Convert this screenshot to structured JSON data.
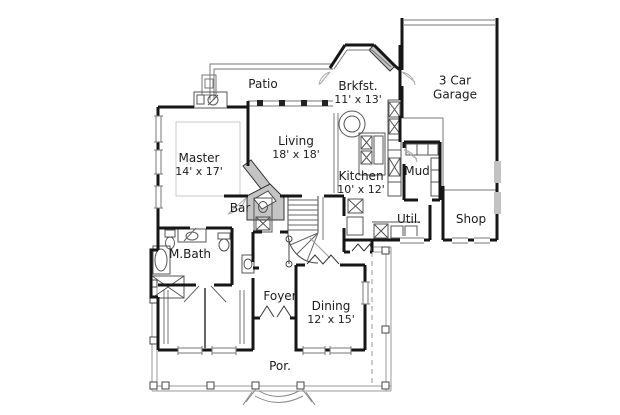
{
  "plan_title": "House floor plan",
  "colors": {
    "wall": "#161616",
    "thin_line": "#555555",
    "light_line": "#9a9a9a",
    "masonry_fill": "#c4c4c4",
    "text": "#1c1c1c",
    "background": "#ffffff"
  },
  "rooms": {
    "patio": {
      "name": "Patio"
    },
    "brkfst": {
      "name": "Brkfst.",
      "dims": "11' x 13'"
    },
    "garage": {
      "line1": "3 Car",
      "line2": "Garage"
    },
    "living": {
      "name": "Living",
      "dims": "18' x 18'"
    },
    "master": {
      "name": "Master",
      "dims": "14' x 17'"
    },
    "kitchen": {
      "name": "Kitchen",
      "dims": "10' x 12'"
    },
    "mud": {
      "name": "Mud"
    },
    "bar": {
      "name": "Bar"
    },
    "util": {
      "name": "Util."
    },
    "shop": {
      "name": "Shop"
    },
    "mbath": {
      "name": "M.Bath"
    },
    "foyer": {
      "name": "Foyer"
    },
    "dining": {
      "name": "Dining",
      "dims": "12' x 15'"
    },
    "porch": {
      "name": "Por."
    }
  }
}
